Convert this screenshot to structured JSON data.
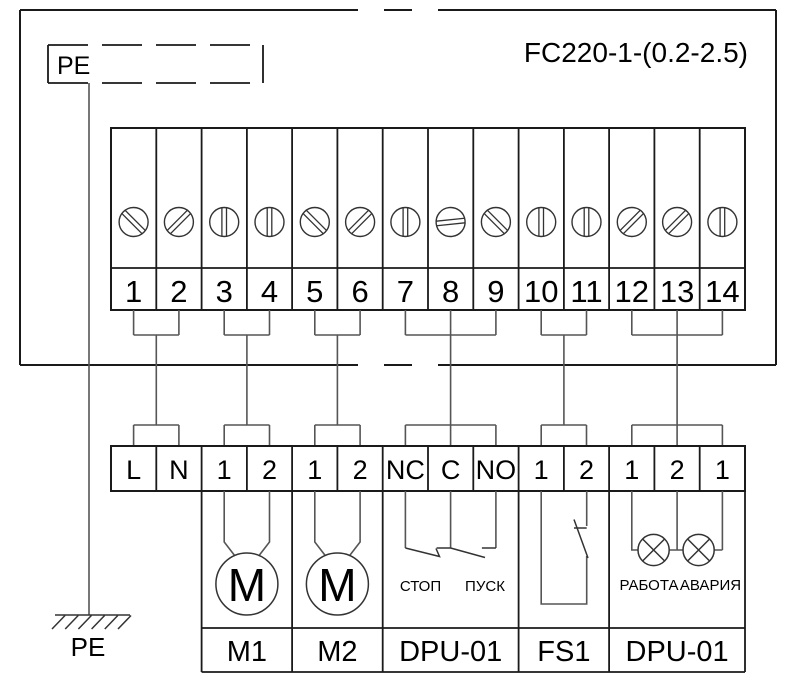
{
  "diagram": {
    "title": "FC220-1-(0.2-2.5)",
    "pe_box_label": "PE",
    "ground_label": "PE"
  },
  "terminal_block": {
    "numbers": [
      "1",
      "2",
      "3",
      "4",
      "5",
      "6",
      "7",
      "8",
      "9",
      "10",
      "11",
      "12",
      "13",
      "14"
    ],
    "screw_icon": "screw-head-icon"
  },
  "connector_strip": {
    "labels": [
      "L",
      "N",
      "1",
      "2",
      "1",
      "2",
      "NC",
      "C",
      "NO",
      "1",
      "2",
      "1",
      "2",
      "1"
    ]
  },
  "devices": {
    "m1": {
      "label": "M1",
      "symbol": "M"
    },
    "m2": {
      "label": "M2",
      "symbol": "M"
    },
    "dpu_buttons": {
      "label": "DPU-01",
      "stop": "СТОП",
      "start": "ПУСК"
    },
    "fs1": {
      "label": "FS1"
    },
    "dpu_lamps": {
      "label": "DPU-01",
      "run": "РАБОТА",
      "alarm": "АВАРИЯ"
    }
  },
  "colors": {
    "background": "#ffffff",
    "structure_line": "#1a1a1a",
    "wire_line": "#555555",
    "text": "#000000"
  }
}
